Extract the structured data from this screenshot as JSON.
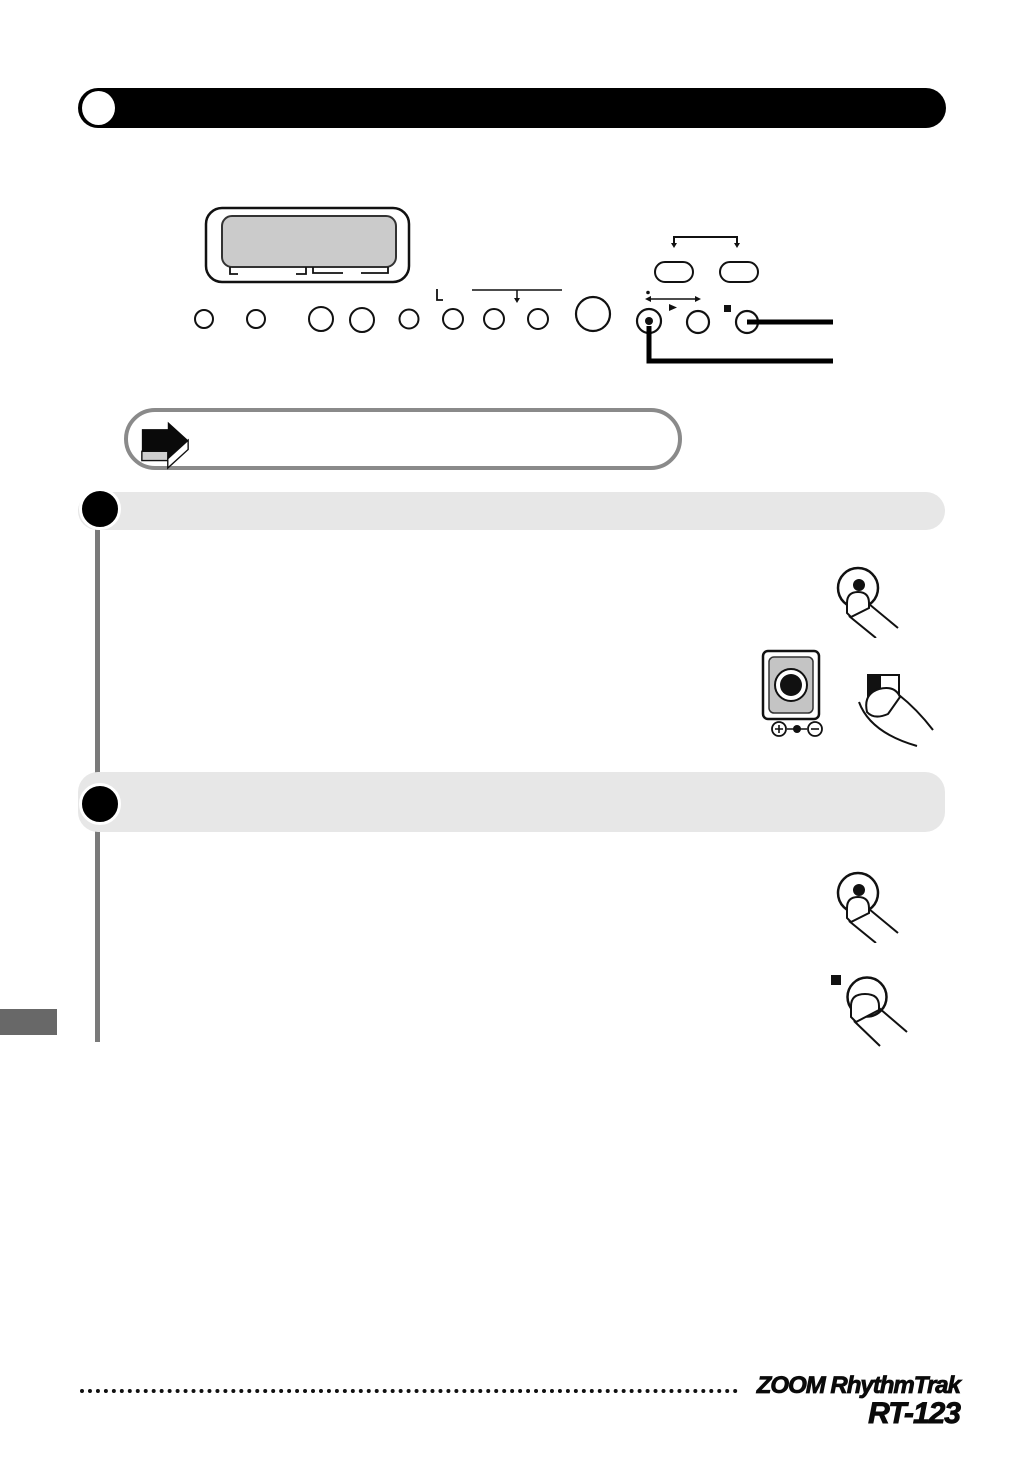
{
  "page": {
    "kind": "scanned-instruction-manual-page",
    "background": "#ffffff"
  },
  "header": {
    "bar_color": "#000000",
    "number_bubble_color": "#ffffff"
  },
  "device_diagram": {
    "lcd_screen_color": "#cbcbcb",
    "outline_color": "#111111",
    "small_button_count": 8,
    "transport": {
      "record_symbol": "dot",
      "play_symbol": "triangle-right",
      "stop_symbol": "square"
    },
    "pill_button_count": 2,
    "callout_line_color": "#000000"
  },
  "callout": {
    "icon": "arrow-right-3d-icon",
    "border_color": "#8a8a8a",
    "text": ""
  },
  "steps": [
    {
      "marker_color": "#000000",
      "bar_color": "#e7e7e7"
    },
    {
      "marker_color": "#000000",
      "bar_color": "#e7e7e7"
    }
  ],
  "illustrations": {
    "finger_press_record": "finger pressing round button with center dot",
    "pad_device": "pad with concentric circles and plus / center / minus level icons",
    "finger_press_pad": "finger pressing half-dark pad key",
    "finger_press_stop": "finger pressing round button with stop square"
  },
  "side_tab_color": "#686868",
  "footer": {
    "brand_line1": "ZOOM RhythmTrak",
    "brand_line2": "RT-123",
    "dotted_rule_color": "#111111"
  }
}
